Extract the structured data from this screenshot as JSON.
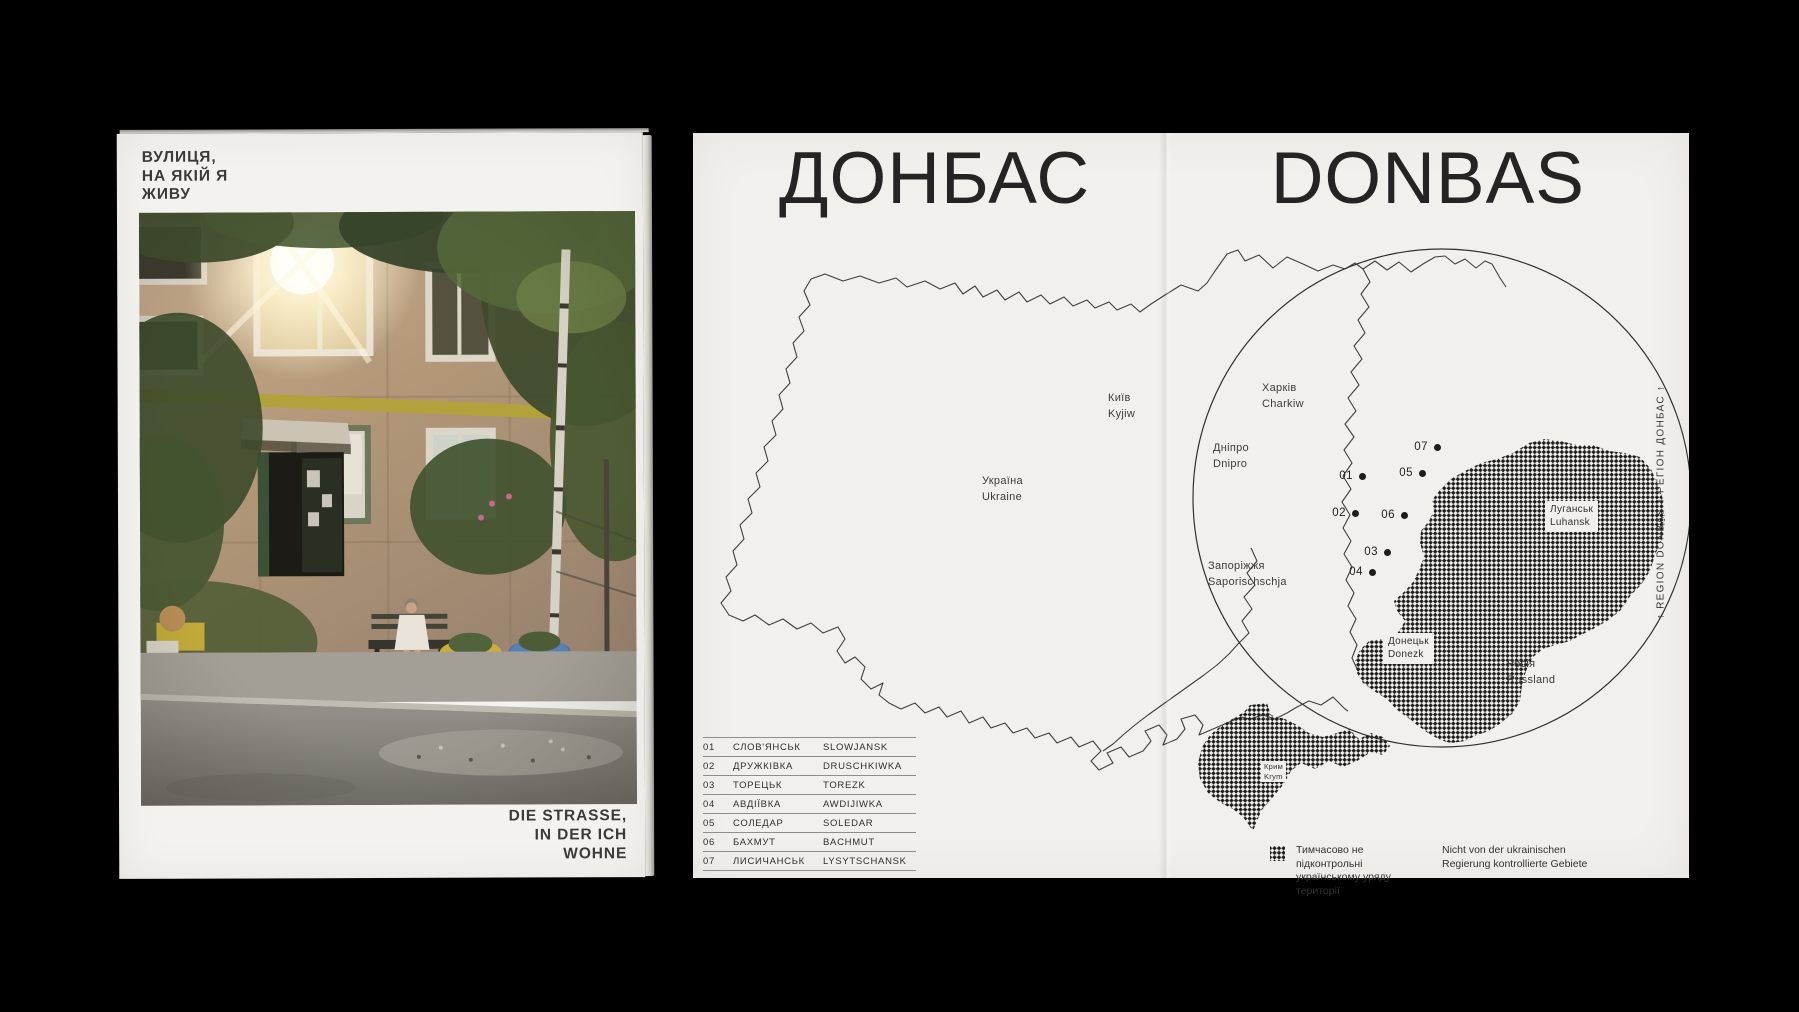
{
  "cover": {
    "title_line1": "ВУЛИЦЯ,",
    "title_line2": "НА ЯКІЙ Я",
    "title_line3": "ЖИВУ",
    "subtitle_line1": "DIE STRASSE,",
    "subtitle_line2": "IN DER ICH",
    "subtitle_line3": "WOHNE",
    "photo_description": "apartment-building-with-woman-on-bench"
  },
  "spread": {
    "title_cyrillic": "ДОНБАС",
    "title_latin": "DONBAS",
    "margin_note": "↑ REGION DONBAS ↑ РЕГІОН ДОНБАС ↑",
    "labels": {
      "kyiv": {
        "line1": "Київ",
        "line2": "Kyjiw"
      },
      "ukraine": {
        "line1": "Україна",
        "line2": "Ukraine"
      },
      "dnipro": {
        "line1": "Дніпро",
        "line2": "Dnipro"
      },
      "kharkiv": {
        "line1": "Харків",
        "line2": "Charkiw"
      },
      "zaporizhzhia": {
        "line1": "Запоріжжя",
        "line2": "Saporischschja"
      },
      "russia": {
        "line1": "Росія",
        "line2": "Russland"
      },
      "luhansk": {
        "line1": "Луганськ",
        "line2": "Luhansk"
      },
      "donetsk": {
        "line1": "Донецьк",
        "line2": "Donezk"
      },
      "crimea": {
        "line1": "Крим",
        "line2": "Krym"
      }
    },
    "markers": [
      {
        "num": "01"
      },
      {
        "num": "02"
      },
      {
        "num": "03"
      },
      {
        "num": "04"
      },
      {
        "num": "05"
      },
      {
        "num": "06"
      },
      {
        "num": "07"
      }
    ],
    "table_rows": [
      {
        "num": "01",
        "uk": "СЛОВ'ЯНСЬК",
        "de": "SLOWJANSK"
      },
      {
        "num": "02",
        "uk": "ДРУЖКІВКА",
        "de": "DRUSCHKIWKA"
      },
      {
        "num": "03",
        "uk": "ТОРЕЦЬК",
        "de": "TOREZK"
      },
      {
        "num": "04",
        "uk": "АВДІЇВКА",
        "de": "AWDIJIWKA"
      },
      {
        "num": "05",
        "uk": "СОЛЕДАР",
        "de": "SOLEDAR"
      },
      {
        "num": "06",
        "uk": "БАХМУТ",
        "de": "BACHMUT"
      },
      {
        "num": "07",
        "uk": "ЛИСИЧАНСЬК",
        "de": "LYSYTSCHANSK"
      }
    ],
    "legend": {
      "uk_line1": "Тимчасово не підконтрольні",
      "uk_line2": "українському уряду території",
      "de_line1": "Nicht von der ukrainischen",
      "de_line2": "Regierung kontrollierte Gebiete"
    }
  },
  "colors": {
    "background": "#000000",
    "paper": "#f1f0ec",
    "cover_paper": "#f3f2ee",
    "ink": "#242424",
    "occupied_hatch": "#1d1d1d"
  }
}
